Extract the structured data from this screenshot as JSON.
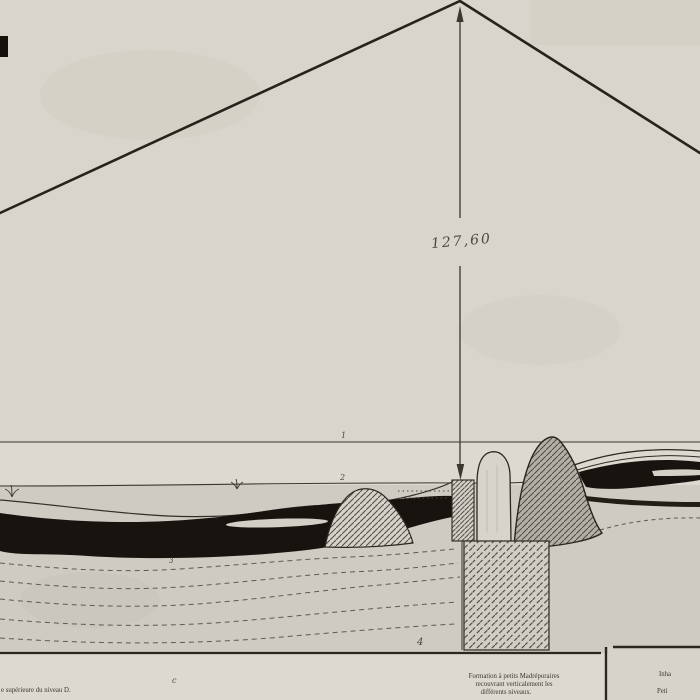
{
  "plate": {
    "dimension": {
      "value": "127,60"
    },
    "marks": {
      "level_1": "1",
      "level_2": "2",
      "level_3": "3",
      "level_4": "4",
      "letter_c": "c"
    },
    "captions": {
      "left": "e supérieure du niveau D.",
      "center_line1": "Formation à petits Madréporaires",
      "center_line2": "recouvrant verticalement les",
      "center_line3": "différents niveaux.",
      "right_line1": "Inha",
      "right_line2": "Peti"
    },
    "colors": {
      "paper": "#d8d5cc",
      "paper_lower": "#cecbc3",
      "caption_strip": "#ddd9d1",
      "ink": "#27221b",
      "black_band": "#17140f",
      "gray_mound": "#b2afa6",
      "hatch": "#4f4a43"
    }
  }
}
